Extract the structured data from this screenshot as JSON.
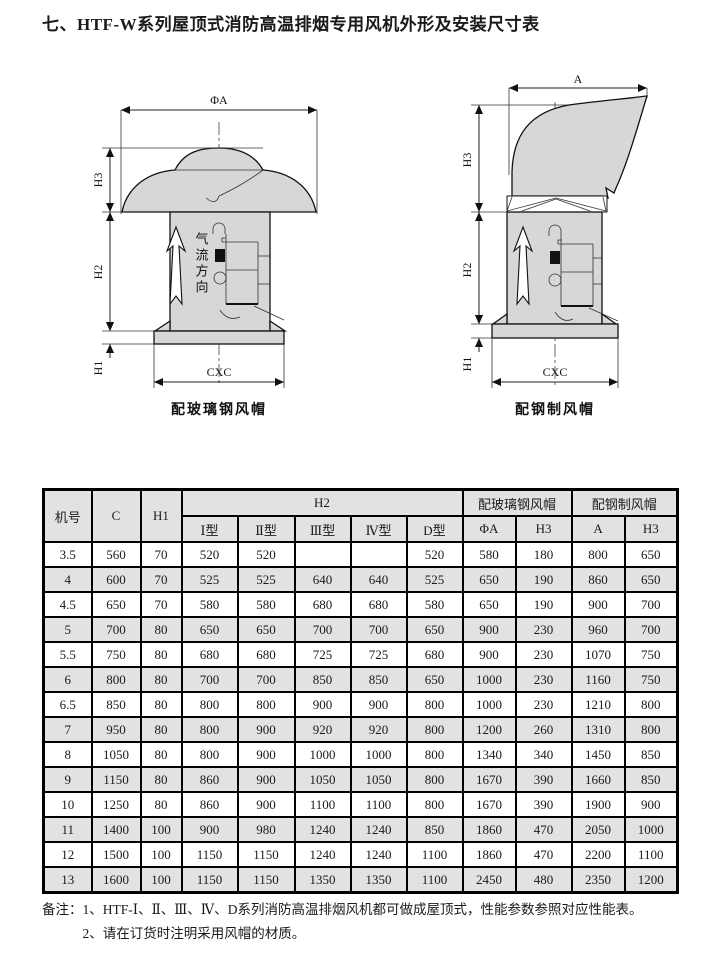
{
  "title": "七、HTF-W系列屋顶式消防高温排烟专用风机外形及安装尺寸表",
  "drawings": {
    "left": {
      "dim_diameter": "ΦA",
      "dim_h3": "H3",
      "dim_h2": "H2",
      "dim_h1": "H1",
      "dim_base": "CXC",
      "airflow_label": "气流方向",
      "caption": "配玻璃钢风帽"
    },
    "right": {
      "dim_width": "A",
      "dim_h3": "H3",
      "dim_h2": "H2",
      "dim_h1": "H1",
      "dim_base": "CXC",
      "caption": "配钢制风帽"
    }
  },
  "table": {
    "header": {
      "col_model": "机号",
      "col_c": "C",
      "col_h1": "H1",
      "group_h2": "H2",
      "h2_types": [
        "Ⅰ型",
        "Ⅱ型",
        "Ⅲ型",
        "Ⅳ型",
        "D型"
      ],
      "group_fiberglass": "配玻璃钢风帽",
      "fiberglass_cols": [
        "ΦA",
        "H3"
      ],
      "group_steel": "配钢制风帽",
      "steel_cols": [
        "A",
        "H3"
      ]
    },
    "rows": [
      [
        "3.5",
        "560",
        "70",
        "520",
        "520",
        "",
        "",
        "520",
        "580",
        "180",
        "800",
        "650"
      ],
      [
        "4",
        "600",
        "70",
        "525",
        "525",
        "640",
        "640",
        "525",
        "650",
        "190",
        "860",
        "650"
      ],
      [
        "4.5",
        "650",
        "70",
        "580",
        "580",
        "680",
        "680",
        "580",
        "650",
        "190",
        "900",
        "700"
      ],
      [
        "5",
        "700",
        "80",
        "650",
        "650",
        "700",
        "700",
        "650",
        "900",
        "230",
        "960",
        "700"
      ],
      [
        "5.5",
        "750",
        "80",
        "680",
        "680",
        "725",
        "725",
        "680",
        "900",
        "230",
        "1070",
        "750"
      ],
      [
        "6",
        "800",
        "80",
        "700",
        "700",
        "850",
        "850",
        "650",
        "1000",
        "230",
        "1160",
        "750"
      ],
      [
        "6.5",
        "850",
        "80",
        "800",
        "800",
        "900",
        "900",
        "800",
        "1000",
        "230",
        "1210",
        "800"
      ],
      [
        "7",
        "950",
        "80",
        "800",
        "900",
        "920",
        "920",
        "800",
        "1200",
        "260",
        "1310",
        "800"
      ],
      [
        "8",
        "1050",
        "80",
        "800",
        "900",
        "1000",
        "1000",
        "800",
        "1340",
        "340",
        "1450",
        "850"
      ],
      [
        "9",
        "1150",
        "80",
        "860",
        "900",
        "1050",
        "1050",
        "800",
        "1670",
        "390",
        "1660",
        "850"
      ],
      [
        "10",
        "1250",
        "80",
        "860",
        "900",
        "1100",
        "1100",
        "800",
        "1670",
        "390",
        "1900",
        "900"
      ],
      [
        "11",
        "1400",
        "100",
        "900",
        "980",
        "1240",
        "1240",
        "850",
        "1860",
        "470",
        "2050",
        "1000"
      ],
      [
        "12",
        "1500",
        "100",
        "1150",
        "1150",
        "1240",
        "1240",
        "1100",
        "1860",
        "470",
        "2200",
        "1100"
      ],
      [
        "13",
        "1600",
        "100",
        "1150",
        "1150",
        "1350",
        "1350",
        "1100",
        "2450",
        "480",
        "2350",
        "1200"
      ]
    ]
  },
  "notes": {
    "label": "备注：",
    "items": [
      "1、HTF-Ⅰ、Ⅱ、Ⅲ、Ⅳ、D系列消防高温排烟风机都可做成屋顶式，性能参数参照对应性能表。",
      "2、请在订货时注明采用风帽的材质。"
    ]
  },
  "colors": {
    "border": "#000000",
    "table_shaded_row": "#e2e2e2",
    "drawing_fill": "#d7d7d7",
    "background": "#ffffff"
  }
}
